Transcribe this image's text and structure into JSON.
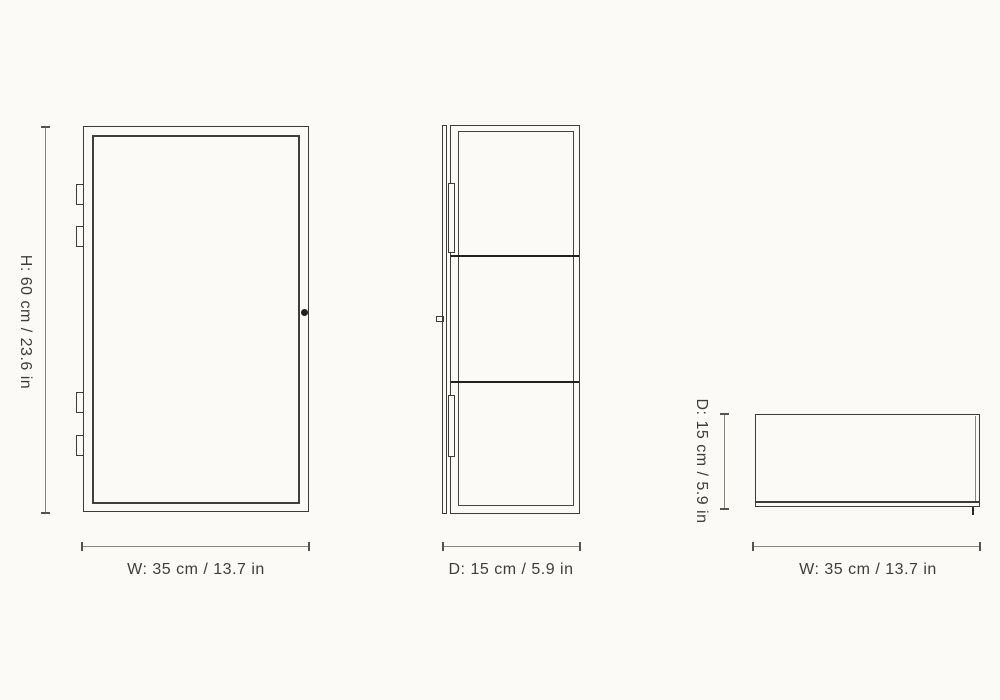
{
  "colors": {
    "background": "#fbfaf6",
    "outline": "#3d3c3a",
    "shelf_line": "#23221f",
    "dimension_line": "#8a8781",
    "dimension_tick": "#55534f",
    "text": "#3e3d3b"
  },
  "views": {
    "front": {
      "height_label": "H: 60 cm / 23.6 in",
      "width_label": "W: 35 cm / 13.7 in"
    },
    "side": {
      "depth_label": "D: 15 cm / 5.9 in"
    },
    "top": {
      "depth_label": "D: 15 cm / 5.9 in",
      "width_label": "W: 35 cm / 13.7 in"
    }
  }
}
